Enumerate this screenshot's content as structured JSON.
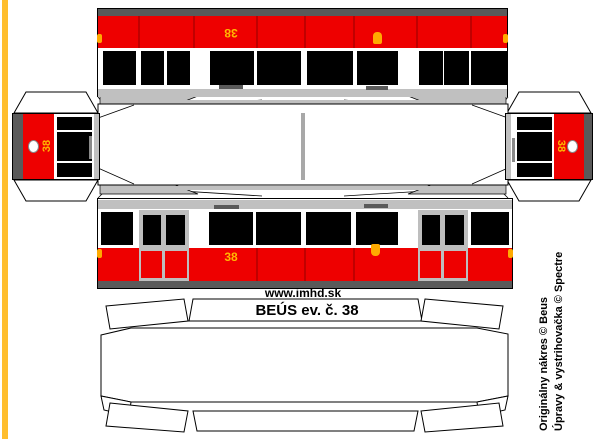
{
  "model": {
    "site_label": "www.imhd.sk",
    "title_label": "BEÚS ev. č. 38",
    "fleet_number": "38",
    "credits_line1": "Originálny nákres © Beus",
    "credits_line2": "Úpravy & vystrihovačka © Spectre"
  },
  "colors": {
    "accent_yellow": "#FFBE2E",
    "body_red": "#EE0000",
    "red_divider": "#C00000",
    "window_black": "#000000",
    "roof_gray": "#C0C0C0",
    "chassis_gray": "#5A5A5A",
    "door_frame_gray": "#BEBEBE",
    "number_yellow": "#FFB800",
    "marker_orange": "#FFAA00"
  }
}
